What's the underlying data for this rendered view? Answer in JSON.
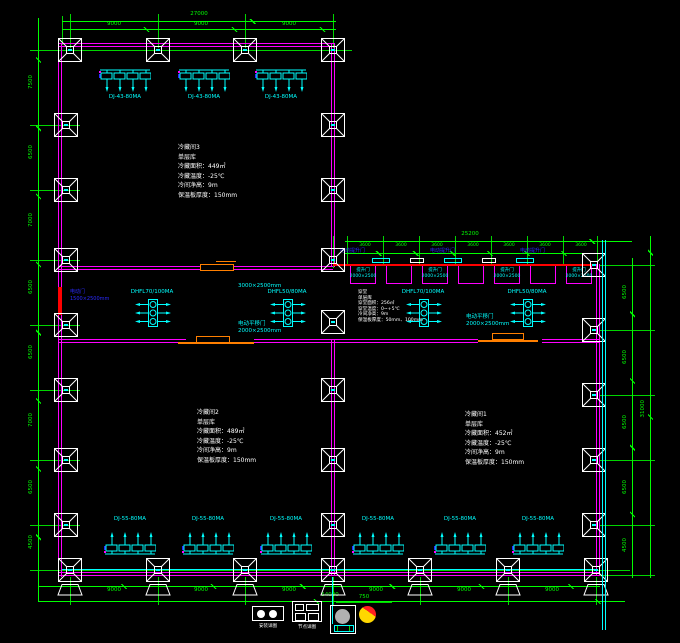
{
  "rooms": {
    "room3": [
      "冷藏间3",
      "单层库",
      "冷藏面积：449㎡",
      "冷藏温度：-25℃",
      "冷间净高：9m",
      "保温板厚度：150mm"
    ],
    "room2": [
      "冷藏间2",
      "单层库",
      "冷藏面积：489㎡",
      "冷藏温度：-25℃",
      "冷间净高：9m",
      "保温板厚度：150mm"
    ],
    "room1": [
      "冷藏间1",
      "单层库",
      "冷藏面积：452㎡",
      "冷藏温度：-25℃",
      "冷间净高：9m",
      "保温板厚度：150mm"
    ],
    "corridor": [
      "穿堂",
      "单层库",
      "穿堂面积：256㎡",
      "穿堂温度：0~+5℃",
      "冷间净高：9m",
      "保温板厚度：50mm、100mm"
    ]
  },
  "equipment": {
    "top_banks": [
      "DJ-43-80MA",
      "DJ-43-80MA",
      "DJ-43-80MA"
    ],
    "bottom_banks": [
      "DJ-55-80MA",
      "DJ-55-80MA",
      "DJ-55-80MA",
      "DJ-55-80MA",
      "DJ-55-80MA",
      "DJ-55-80MA"
    ],
    "corridor_units": [
      "DHFL70/100MA",
      "DHFL50/80MA",
      "DHFL70/100MA",
      "DHFL50/80MA"
    ]
  },
  "doors": {
    "corridor_top_size": "3000×2500mm",
    "room2_door": [
      "电动平移门",
      "2000×2500mm"
    ],
    "room1_door": [
      "电动平移门",
      "2000×2500mm"
    ],
    "left_door": [
      "电动门",
      "1500×2500mm"
    ],
    "dock_type": "电动提升门",
    "dock_bay": [
      "提升门",
      "2000×2500"
    ]
  },
  "dims": {
    "top": {
      "overall": "27000",
      "segs": [
        "9000",
        "9000",
        "9000"
      ]
    },
    "wing": {
      "overall": "25200",
      "segs": [
        "3600",
        "3600",
        "3600",
        "3600",
        "3600",
        "3600",
        "3600"
      ]
    },
    "bottom": {
      "overall": "54000",
      "segs": [
        "9000",
        "9000",
        "9000",
        "9000",
        "9000",
        "9000"
      ]
    },
    "left": {
      "segs": [
        "7500",
        "6500",
        "7000",
        "6500",
        "6500",
        "7000",
        "6500",
        "4500"
      ]
    },
    "right": {
      "overall": "31000",
      "segs": [
        "6500",
        "6500",
        "6500",
        "6500",
        "4500"
      ]
    },
    "legend": "750"
  },
  "legend": {
    "item1": "安装详图",
    "item2": "节点详图"
  },
  "colors": {
    "wall": "#ff00ff",
    "dimension": "#00ff00",
    "equipment": "#00ffff",
    "dock_wall": "#ff0000",
    "door": "#ff7f00",
    "door_label": "#2b2bff"
  }
}
